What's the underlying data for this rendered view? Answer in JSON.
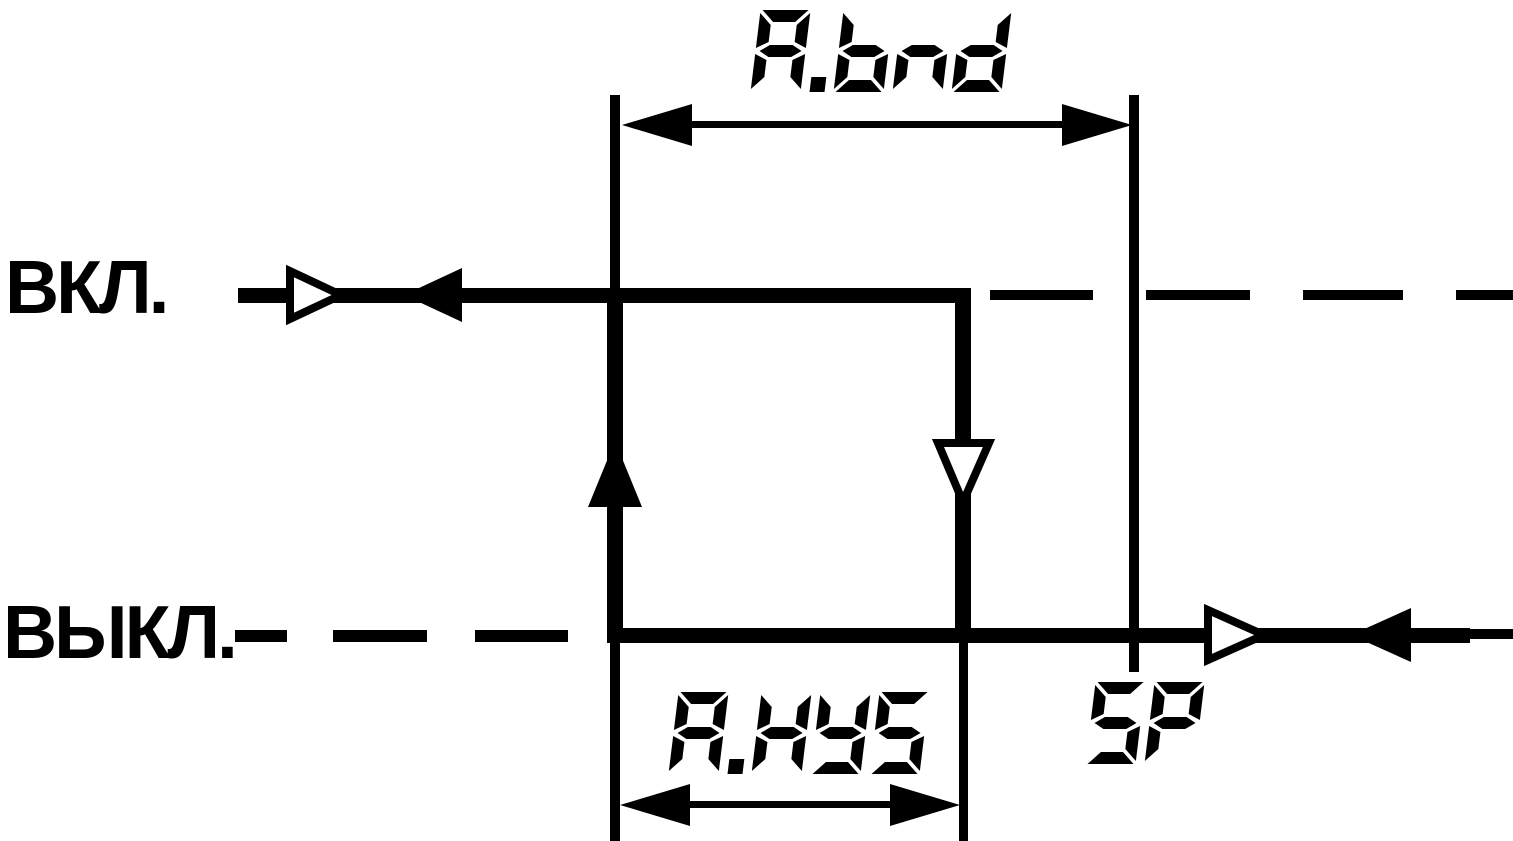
{
  "labels": {
    "on": "ВКЛ.",
    "off": "ВЫКЛ."
  },
  "seg_labels": {
    "band": "A.bnd",
    "hysteresis": "A.HYS",
    "setpoint": "SP"
  },
  "colors": {
    "ink": "#000000",
    "background": "#ffffff"
  }
}
